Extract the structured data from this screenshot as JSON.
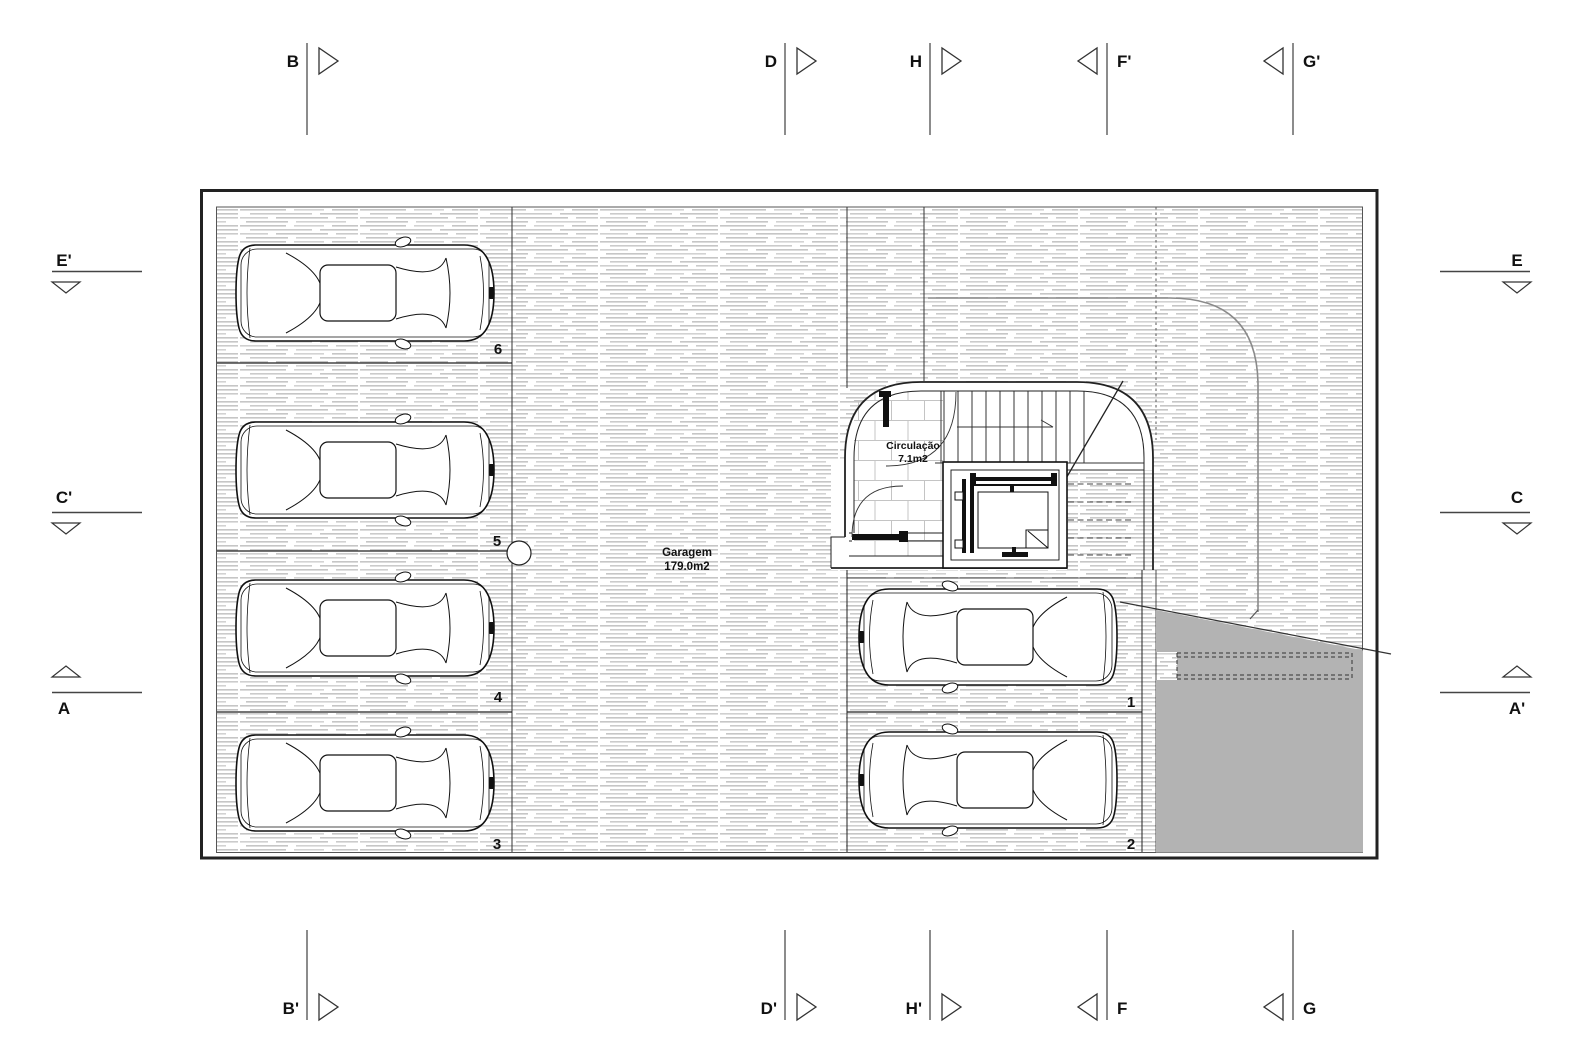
{
  "rooms": {
    "garagem": {
      "name": "Garagem",
      "area": "179.0m2"
    },
    "circulacao": {
      "name": "Circulação",
      "area": "7.1m2"
    }
  },
  "parking_spaces": {
    "s1": "1",
    "s2": "2",
    "s3": "3",
    "s4": "4",
    "s5": "5",
    "s6": "6"
  },
  "section_markers": {
    "top": [
      {
        "label": "B"
      },
      {
        "label": "D"
      },
      {
        "label": "H"
      },
      {
        "label": "F'"
      },
      {
        "label": "G'"
      }
    ],
    "bottom": [
      {
        "label": "B'"
      },
      {
        "label": "D'"
      },
      {
        "label": "H'"
      },
      {
        "label": "F"
      },
      {
        "label": "G"
      }
    ],
    "left": [
      {
        "label": "E'"
      },
      {
        "label": "C'"
      },
      {
        "label": "A"
      }
    ],
    "right": [
      {
        "label": "E"
      },
      {
        "label": "C"
      },
      {
        "label": "A'"
      }
    ]
  },
  "colors": {
    "line": "#1a1a1a",
    "hatch": "#c6c6c6",
    "tile": "#c4c4c4",
    "gray_fill": "#b3b3b3",
    "curve": "#8a8a8a"
  }
}
